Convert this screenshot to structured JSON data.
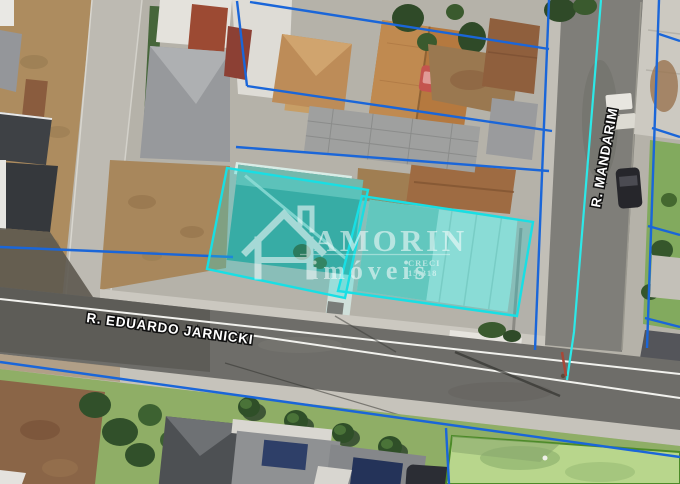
{
  "map": {
    "street_labels": {
      "horizontal": "R. EDUARDO JARNICKI",
      "vertical": "R. MANDARIM"
    },
    "watermark": {
      "brand": "AMORIN",
      "subtitle": "imóveis",
      "creci_label": "CRECI",
      "creci_number": "15.318"
    },
    "colors": {
      "boundary_blue": "#1a66d9",
      "highlight_cyan": "#18dfe4",
      "highlight_fill": "rgba(35,220,220,0.30)",
      "road_centerline_cyan": "#2ce8e8",
      "green_lot_outline": "#4c8a28",
      "green_lot_fill": "#b8d68c",
      "watermark_white": "#ffffff"
    }
  }
}
